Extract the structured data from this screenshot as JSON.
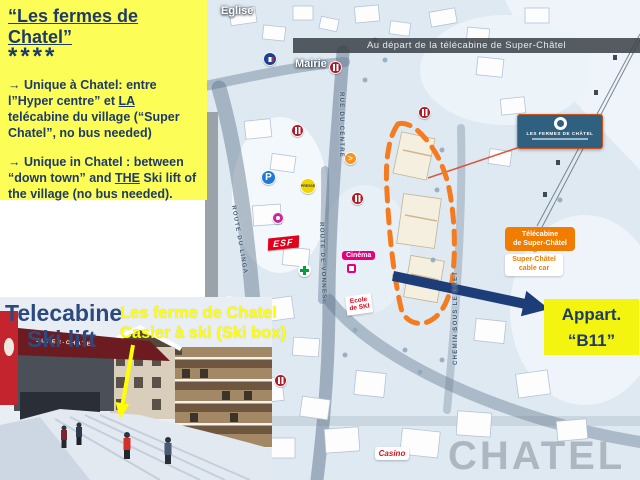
{
  "note": {
    "title": "“Les fermes de Chatel”",
    "stars": "****",
    "fr": {
      "p1": "→ Unique à Chatel: entre l”Hyper centre” et ",
      "u": "LA",
      "p2": " telécabine du village (“Super Chatel”, no bus needed)"
    },
    "en": {
      "p1": "→ Unique in Chatel : between “down town” and ",
      "u": "THE",
      "p2": " Ski lift of the village (no bus needed)."
    }
  },
  "map": {
    "banner": "Au départ de la télécabine de Super-Châtel",
    "labels": {
      "eglise": "Eglise",
      "mairie": "Mairie",
      "cinema": "Cinéma",
      "ecole_l1": "Ecole",
      "ecole_l2": "de SKI",
      "casino": "Casino",
      "watermark": "CHATEL"
    },
    "streets": {
      "rue_du_centre": "RUE DU CENTRE",
      "route_du_linga": "ROUTE DU LINGA",
      "route_de_vonnes": "ROUTE DE VONNES",
      "chemin_sous_le_cret": "CHEMIN SOUS LE CRET"
    },
    "icons": {
      "parking": "P",
      "presse": "PRESSE",
      "esf": "ESF",
      "direction": ">"
    },
    "fermes_box": {
      "title": "LES FERMES DE CHÂTEL"
    },
    "telecabine_fr_l1": "Télécabine",
    "telecabine_fr_l2": "de Super-Châtel",
    "telecabine_en_l1": "Super-Châtel",
    "telecabine_en_l2": "cable car"
  },
  "photo": {
    "caption_l1": "Telecabine",
    "caption_l2": "Ski lift",
    "annotation_l1": "Les ferme de Chatel",
    "annotation_l2": "Casier à ski (Ski box)",
    "station_sign": "SUPER-CHATEL"
  },
  "b11": {
    "line1": "Appart.",
    "line2": "“B11”"
  },
  "colors": {
    "highlight_yellow": "#fdfd57",
    "navy_text": "#1e3a66",
    "orange_outline": "#f47b20",
    "arrow_blue": "#1d3d78",
    "annotation_yellow": "#ffff00"
  }
}
